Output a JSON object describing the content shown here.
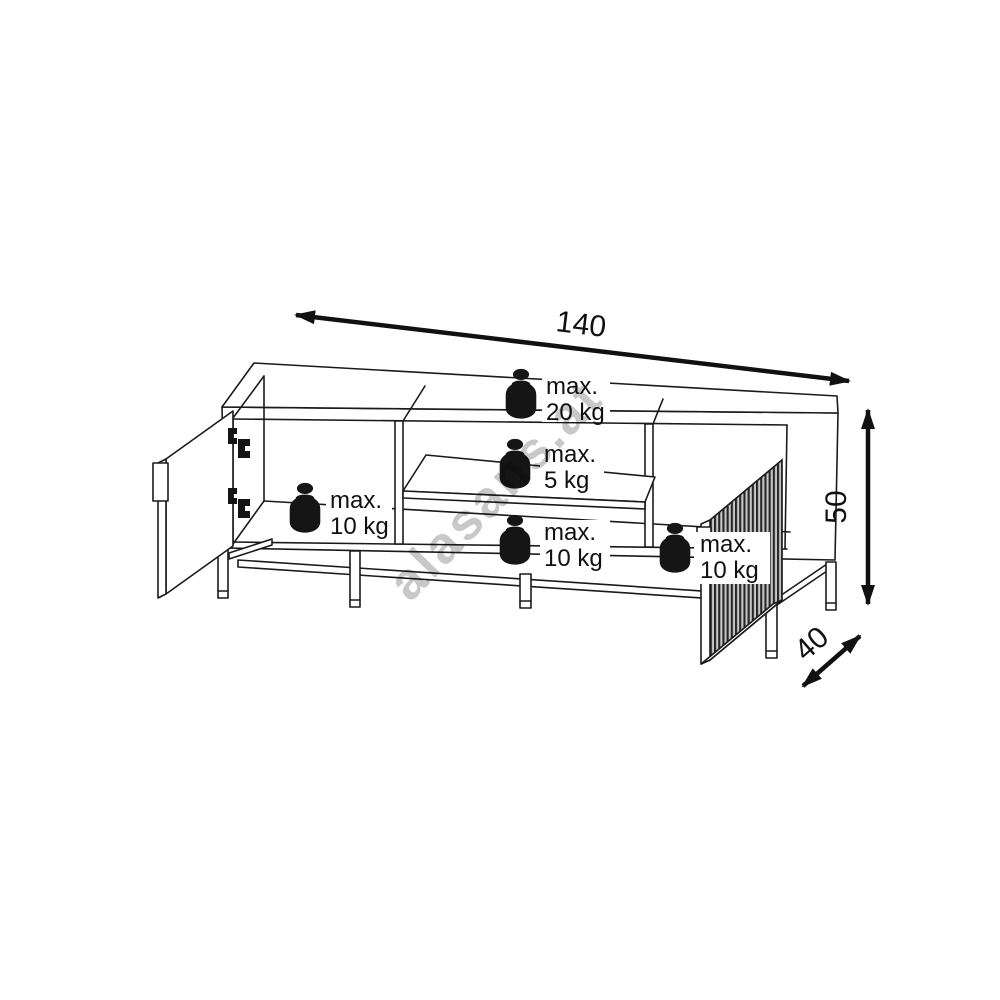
{
  "watermark": {
    "text": "alasans.at"
  },
  "dimensions": {
    "width": "140",
    "height": "50",
    "depth": "40"
  },
  "weight_limits": {
    "top_surface": {
      "line1": "max.",
      "line2": "20 kg"
    },
    "middle_shelf_upper": {
      "line1": "max.",
      "line2": "5 kg"
    },
    "left_compartment": {
      "line1": "max.",
      "line2": "10 kg"
    },
    "middle_lower": {
      "line1": "max.",
      "line2": "10 kg"
    },
    "right_compartment": {
      "line1": "max.",
      "line2": "10 kg"
    }
  },
  "icons": {
    "weight": "weight-icon",
    "hinge": "hinge-icon"
  },
  "colors": {
    "line": "#1a1a1a",
    "background": "#ffffff",
    "watermark_gray": "#c8c8c8",
    "hardware_black": "#151515",
    "fluted_light": "#c6c6c6",
    "fluted_dark": "#262626"
  }
}
